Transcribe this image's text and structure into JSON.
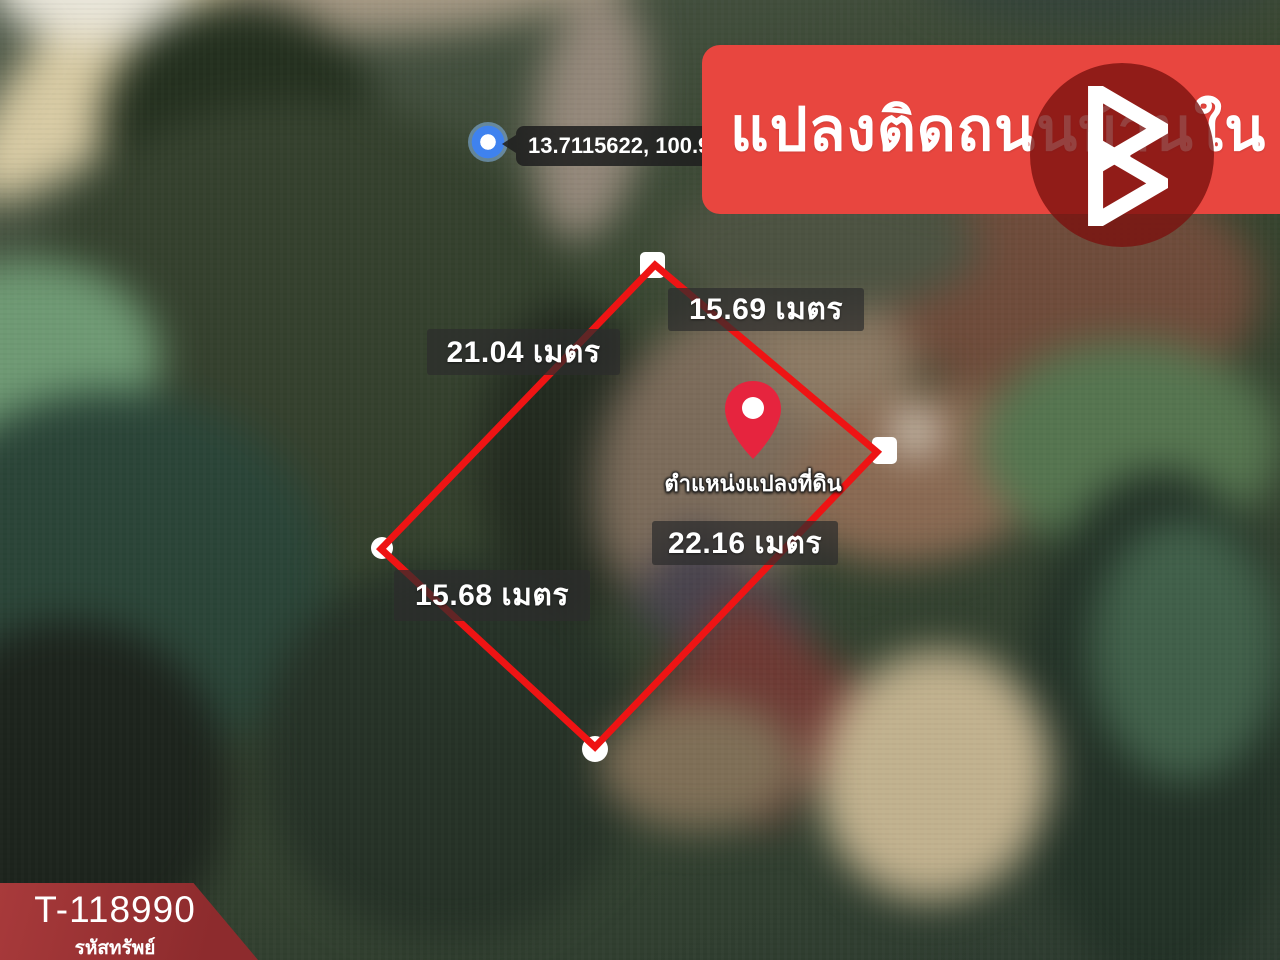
{
  "banner": {
    "title": "แปลงติดถนนบ้านใน"
  },
  "map": {
    "coordinates": "13.7115622, 100.921",
    "pin_label": "ตำแหน่งแปลงที่ดิน",
    "measurements": [
      {
        "side": "top-right-edge",
        "value": "15.69 เมตร"
      },
      {
        "side": "top-left-edge",
        "value": "21.04 เมตร"
      },
      {
        "side": "bottom-left-edge",
        "value": "15.68 เมตร"
      },
      {
        "side": "bottom-right-edge",
        "value": "22.16 เมตร"
      }
    ]
  },
  "badge": {
    "code": "T-118990",
    "label": "รหัสทรัพย์"
  },
  "icons": {
    "logo": "brand-b-triangles-logo",
    "pin": "location-pin-icon",
    "vertex": "plot-corner-marker",
    "dot": "map-point-blue-dot"
  },
  "colors": {
    "banner_red": "#E8463F",
    "logo_circle_red": "#7A120F",
    "plot_outline_red": "#EE1414",
    "badge_red": "#9E3132",
    "pin_red": "#E6243E",
    "label_bg": "rgba(45,45,45,0.72)",
    "tooltip_bg": "rgba(32,32,32,0.88)"
  }
}
